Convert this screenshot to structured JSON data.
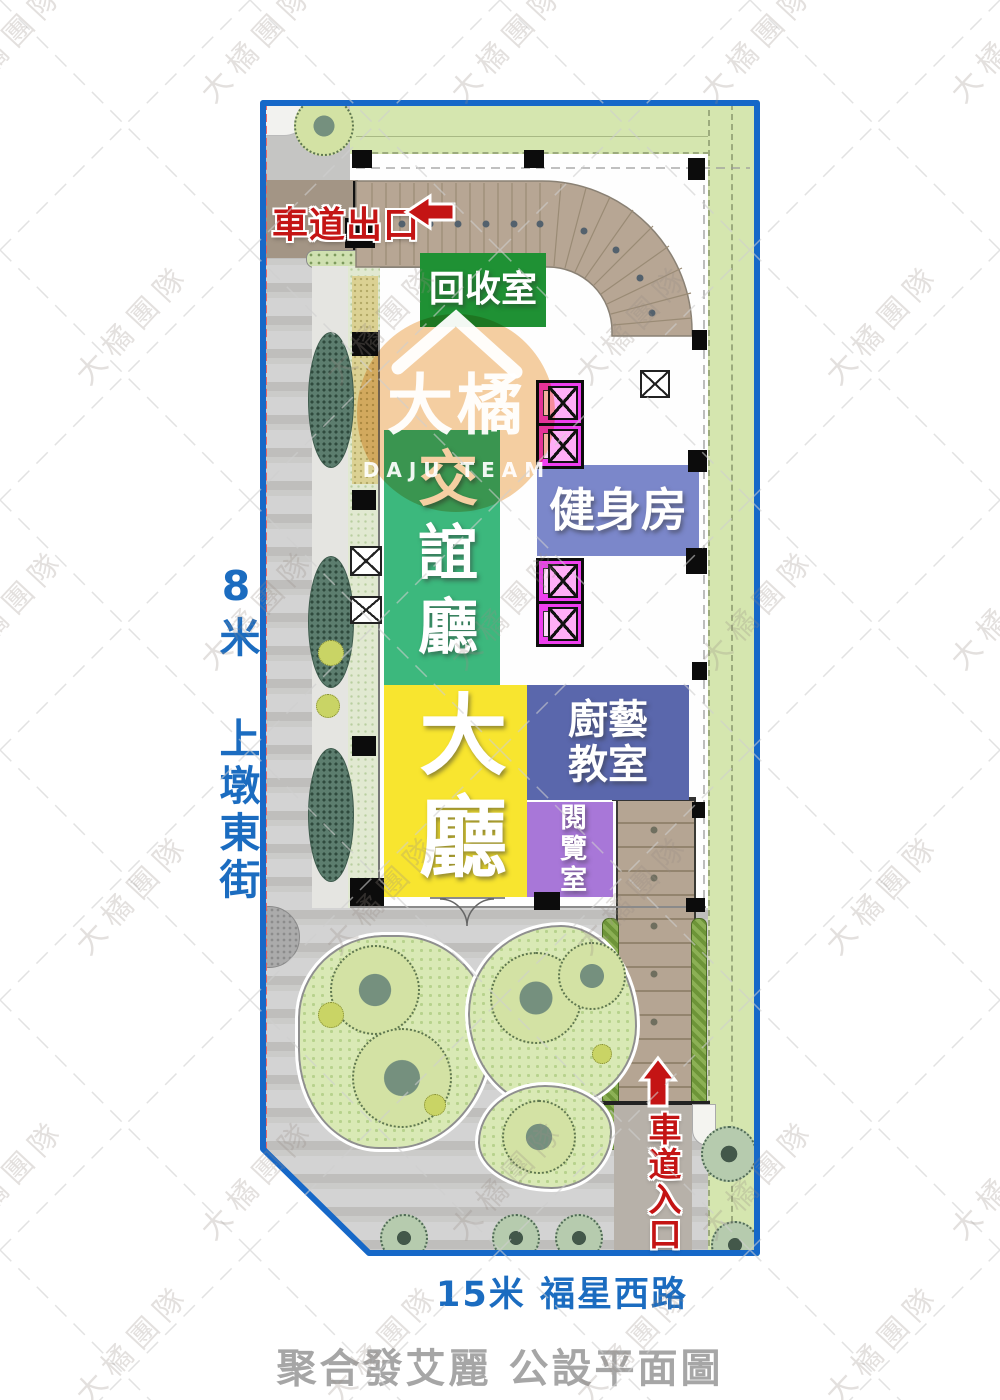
{
  "title": "聚合發艾麗 公設平面圖",
  "streets": {
    "left": "8米 上墩東街",
    "bottom": "15米 福星西路"
  },
  "driveway": {
    "exit": "車道出口",
    "entrance": "車道入口"
  },
  "rooms": {
    "recycling": {
      "label": "回收室",
      "color": "#1f9134"
    },
    "lounge": {
      "label": "交誼廳",
      "color": "#3cb87d"
    },
    "gym": {
      "label": "健身房",
      "color": "#7b87ca"
    },
    "lobby": {
      "label": "大廳",
      "color": "#f8e52f"
    },
    "cooking": {
      "label": "廚藝教室",
      "color": "#5a67ac"
    },
    "reading": {
      "label": "閱覽室",
      "color": "#a877d8"
    }
  },
  "watermark": {
    "text": "大橘團隊",
    "logo": "大橘",
    "logo_sub": "DAJU TEAM"
  },
  "colors": {
    "plan_border": "#1668c8",
    "street_label": "#1b6cc0",
    "title_gray": "#a6a6a6",
    "driveway_label": "#c41414",
    "greenbelt": "#d5e6af",
    "ramp": "#b5a593",
    "elevator": "#ef3fef",
    "watermark_circle": "#f5cfa2"
  }
}
